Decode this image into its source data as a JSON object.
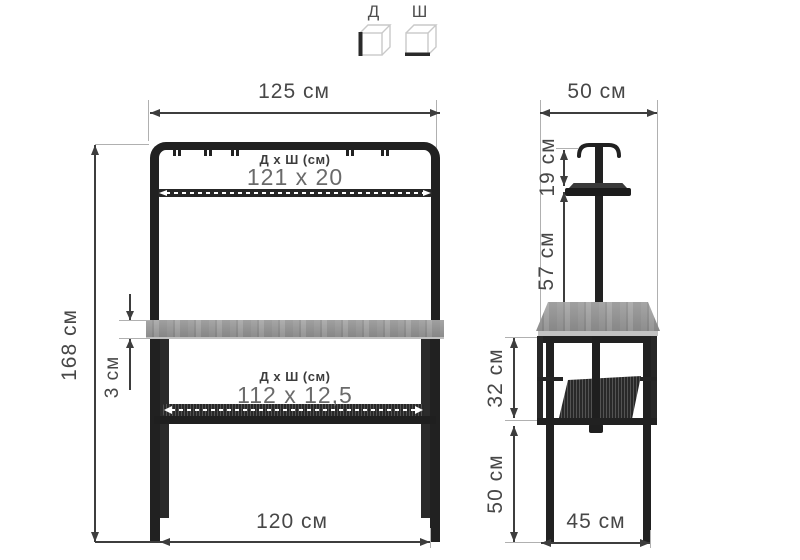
{
  "legend": {
    "d": "Д",
    "sh": "Ш"
  },
  "front": {
    "width_top": "125 см",
    "height": "168 см",
    "desk_thickness": "3 см",
    "width_bottom": "120 см",
    "upper_shelf_label": "Д х Ш (см)",
    "upper_shelf_size": "121 x 20",
    "lower_shelf_label": "Д х Ш (см)",
    "lower_shelf_size": "112 x 12,5"
  },
  "side": {
    "depth_top": "50 см",
    "rail_to_shelf": "19 см",
    "shelf_to_desk": "57 см",
    "desk_to_shelf2": "32 см",
    "shelf2_to_floor": "50 см",
    "depth_bottom": "45 см"
  },
  "colors": {
    "frame": "#212121",
    "wood": "#9a9a9a",
    "dimension": "#3d3d3d",
    "value_text": "#6a6a6a",
    "background": "#ffffff"
  }
}
